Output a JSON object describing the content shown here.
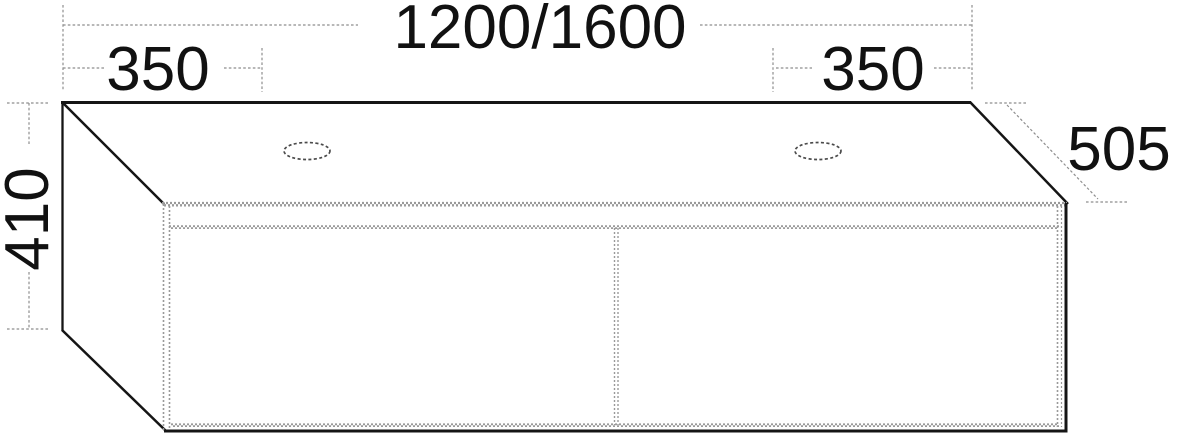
{
  "drawing": {
    "kind": "technical dimension drawing",
    "subject": "double washbasin vanity unit with two drawers and two tap holes"
  },
  "labels": {
    "overall_width": "1200/1600",
    "left_tap_offset": "350",
    "right_tap_offset": "350",
    "height": "410",
    "depth": "505"
  },
  "colors": {
    "background": "#ffffff",
    "solid_line": "#151515",
    "dimension_line": "#8e8e8e",
    "hatch_line": "#9a9a9a",
    "text": "#111111"
  }
}
